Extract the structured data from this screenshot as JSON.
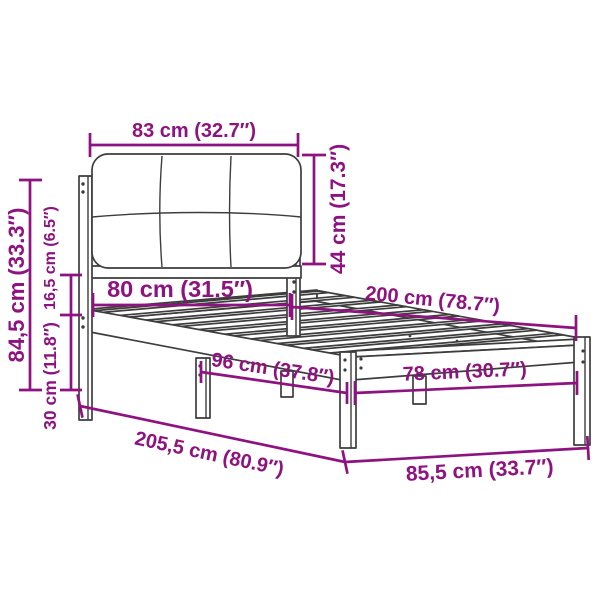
{
  "diagram": {
    "accent_color": "#8e1280",
    "outline_color": "#3d3d3d",
    "background_color": "#ffffff",
    "labels": {
      "headboard_width": "83 cm (32.7″)",
      "headboard_height": "44 cm (17.3″)",
      "headboard_inner_width": "80 cm (31.5″)",
      "bed_length": "200 cm (78.7″)",
      "overall_height": "84,5 cm (33.3″)",
      "rail_to_headboard_gap": "16,5 cm (6.5″)",
      "platform_height": "30 cm (11.8″)",
      "mid_width": "96 cm (37.8″)",
      "foot_inner_width": "78 cm (30.7″)",
      "overall_length": "205,5 cm (80.9″)",
      "overall_width": "85,5 cm (33.7″)"
    }
  }
}
